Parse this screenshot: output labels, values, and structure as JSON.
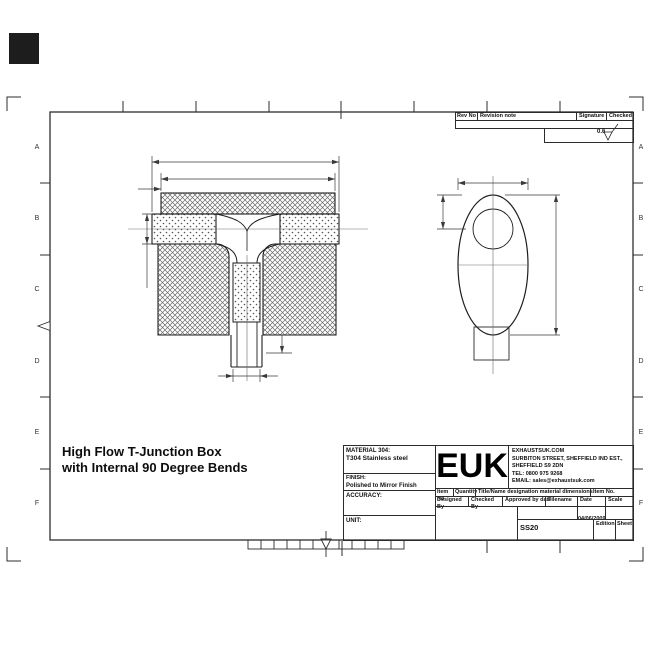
{
  "frame": {
    "row_labels": [
      "A",
      "B",
      "C",
      "D",
      "E",
      "F"
    ]
  },
  "revision_table": {
    "headers": [
      "Rev No",
      "Revision note",
      "Signature",
      "Checked"
    ],
    "surface_finish": "0.6"
  },
  "drawing_title": {
    "line1": "High Flow T-Junction Box",
    "line2": "with Internal 90 Degree Bends"
  },
  "title_block": {
    "material_label": "MATERIAL 304:",
    "material_value": "T304 Stainless steel",
    "finish_label": "FINISH:",
    "finish_value": "Polished to Mirror Finish",
    "accuracy_label": "ACCURACY:",
    "unit_label": "UNIT:",
    "logo": "EUK",
    "company": {
      "line1": "EXHAUSTSUK.COM",
      "line2": "SURBITON STREET, SHEFFIELD IND EST.,",
      "line3": "SHEFFIELD S9 2DN",
      "line4": "TEL: 0800 975 9268",
      "line5": "EMAIL: sales@exhaustsuk.com"
    },
    "item_row": [
      "Item No",
      "Quantity",
      "Title/Name designation material dimensions",
      "Item No."
    ],
    "approval_row": [
      "Designed By",
      "Checked By",
      "Approved by date",
      "Filename",
      "Date",
      "Scale"
    ],
    "date_value": "04/06/2009",
    "part_number": "SS20",
    "edition_label": "Edition",
    "sheet_label": "Sheet"
  }
}
